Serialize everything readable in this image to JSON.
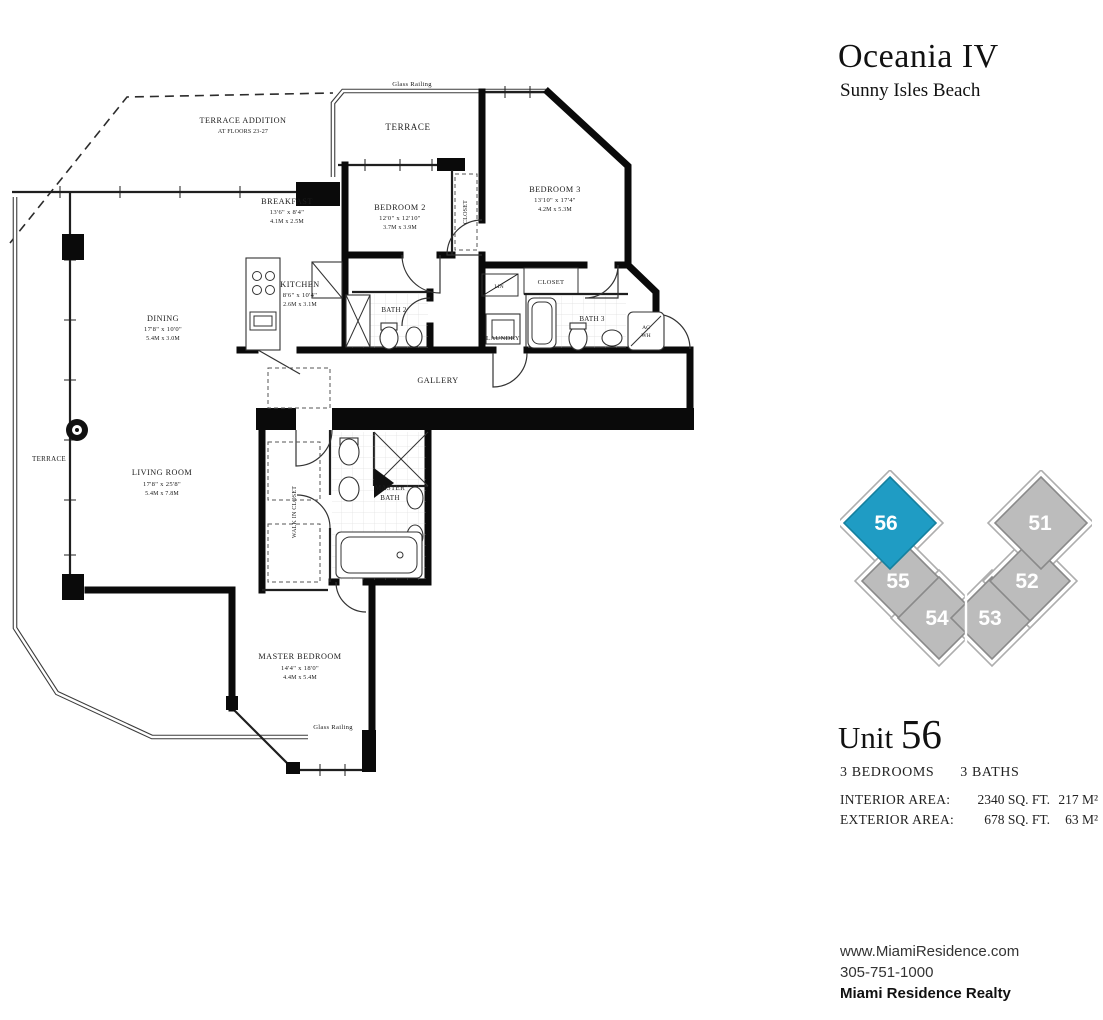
{
  "header": {
    "title": "Oceania IV",
    "subtitle": "Sunny Isles Beach"
  },
  "keyplan": {
    "highlight_color": "#1f9cc4",
    "unit_color": "#bcbcbc",
    "units": [
      {
        "number": "56",
        "color": "#1f9cc4",
        "highlighted": true
      },
      {
        "number": "55",
        "color": "#bcbcbc",
        "highlighted": false
      },
      {
        "number": "54",
        "color": "#bcbcbc",
        "highlighted": false
      },
      {
        "number": "53",
        "color": "#bcbcbc",
        "highlighted": false
      },
      {
        "number": "52",
        "color": "#bcbcbc",
        "highlighted": false
      },
      {
        "number": "51",
        "color": "#bcbcbc",
        "highlighted": false
      }
    ]
  },
  "unit_info": {
    "unit_word": "Unit ",
    "unit_number": "56",
    "bedrooms": "3 BEDROOMS",
    "baths": "3 BATHS",
    "areas": [
      {
        "label": "INTERIOR AREA:",
        "sqft": "2340 SQ. FT.",
        "m2": "217 M²"
      },
      {
        "label": "EXTERIOR AREA:",
        "sqft": "678 SQ. FT.",
        "m2": "63 M²"
      }
    ]
  },
  "footer": {
    "website": "www.MiamiResidence.com",
    "phone": "305-751-1000",
    "realty": "Miami Residence Realty"
  },
  "fp": {
    "terrace_addition": [
      "TERRACE ADDITION",
      "AT FLOORS 23-27"
    ],
    "glass_railing": "Glass Railing",
    "terrace": "TERRACE",
    "gallery": "GALLERY",
    "breakfast": {
      "n": "BREAKFAST",
      "f": "13'6\" x 8'4\"",
      "m": "4.1M x 2.5M"
    },
    "kitchen": {
      "n": "KITCHEN",
      "f": "8'6\" x 10'4\"",
      "m": "2.6M x 3.1M"
    },
    "dining": {
      "n": "DINING",
      "f": "17'8\" x 10'0\"",
      "m": "5.4M x 3.0M"
    },
    "living": {
      "n": "LIVING ROOM",
      "f": "17'8\" x 25'8\"",
      "m": "5.4M x 7.8M"
    },
    "bedroom2": {
      "n": "BEDROOM 2",
      "f": "12'0\" x 12'10\"",
      "m": "3.7M x 3.9M"
    },
    "bedroom3": {
      "n": "BEDROOM 3",
      "f": "13'10\" x 17'4\"",
      "m": "4.2M x 5.3M"
    },
    "master_bedroom": {
      "n": "MASTER BEDROOM",
      "f": "14'4\" x 18'0\"",
      "m": "4.4M x 5.4M"
    },
    "master_bath": [
      "MASTER",
      "BATH"
    ],
    "bath2": "BATH 2",
    "bath3": "BATH 3",
    "laundry": "LAUNDRY",
    "lin": "LIN",
    "closet": "CLOSET",
    "walk_in_closet": "WALK IN CLOSET",
    "ac": "AC",
    "wh": "WH"
  }
}
